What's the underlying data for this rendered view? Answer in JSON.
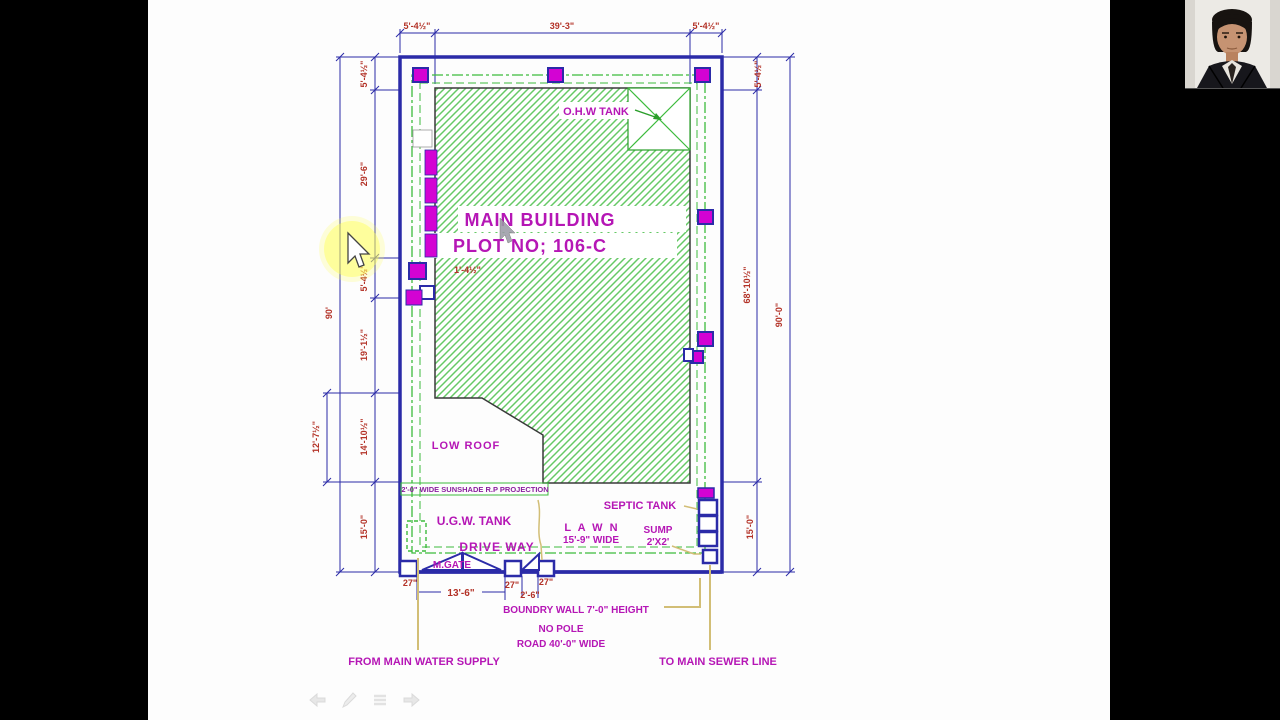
{
  "plan": {
    "title_line1": "MAIN BUILDING",
    "title_line2": "PLOT NO; 106-C",
    "labels": {
      "ohw_tank": "O.H.W TANK",
      "low_roof": "LOW ROOF",
      "sunshade": "2'-0\" WIDE SUNSHADE R.P PROJECTION",
      "ugw_tank": "U.G.W. TANK",
      "drive_way": "DRIVE WAY",
      "m_gate": "M.GATE",
      "lawn_1": "L A W N",
      "lawn_2": "15'-9\" WIDE",
      "septic_tank": "SEPTIC TANK",
      "sump_1": "SUMP",
      "sump_2": "2'X2'",
      "boundary_wall": "BOUNDRY WALL 7'-0\" HEIGHT",
      "no_pole": "NO POLE",
      "road": "ROAD 40'-0\" WIDE",
      "water_supply": "FROM MAIN WATER SUPPLY",
      "sewer_line": "TO MAIN SEWER LINE"
    },
    "dims": {
      "top_left": "5'-4½\"",
      "top_mid": "39'-3\"",
      "top_right": "5'-4½\"",
      "left_a": "5'-4½\"",
      "left_b": "29'-6\"",
      "left_c": "5'-4½\"",
      "left_d": "19'-1½\"",
      "left_e": "14'-10½\"",
      "left_f": "15'-0\"",
      "left_overall": "90'",
      "left_offset": "12'-7½\"",
      "right_a": "5'-4½\"",
      "right_b": "68'-10½\"",
      "right_c": "15'-0\"",
      "right_overall": "90'-0\"",
      "pillar_a": "27\"",
      "pillar_b": "27\"",
      "pillar_c": "27\"",
      "gate_main": "13'-6\"",
      "gate_small": "2'-6\"",
      "column": "1'-4½\""
    },
    "colors": {
      "wall_blue": "#2b2ba8",
      "dim_red": "#b33227",
      "label_magenta": "#b516b5",
      "box_magenta": "#d303d3",
      "setback_green": "#3dbb3d",
      "hatch_green": "#66c966",
      "leader_tan": "#d2be76",
      "cursor_highlight": "#ffff55"
    },
    "icons": [
      "back-arrow",
      "pencil",
      "menu",
      "forward-arrow"
    ]
  }
}
